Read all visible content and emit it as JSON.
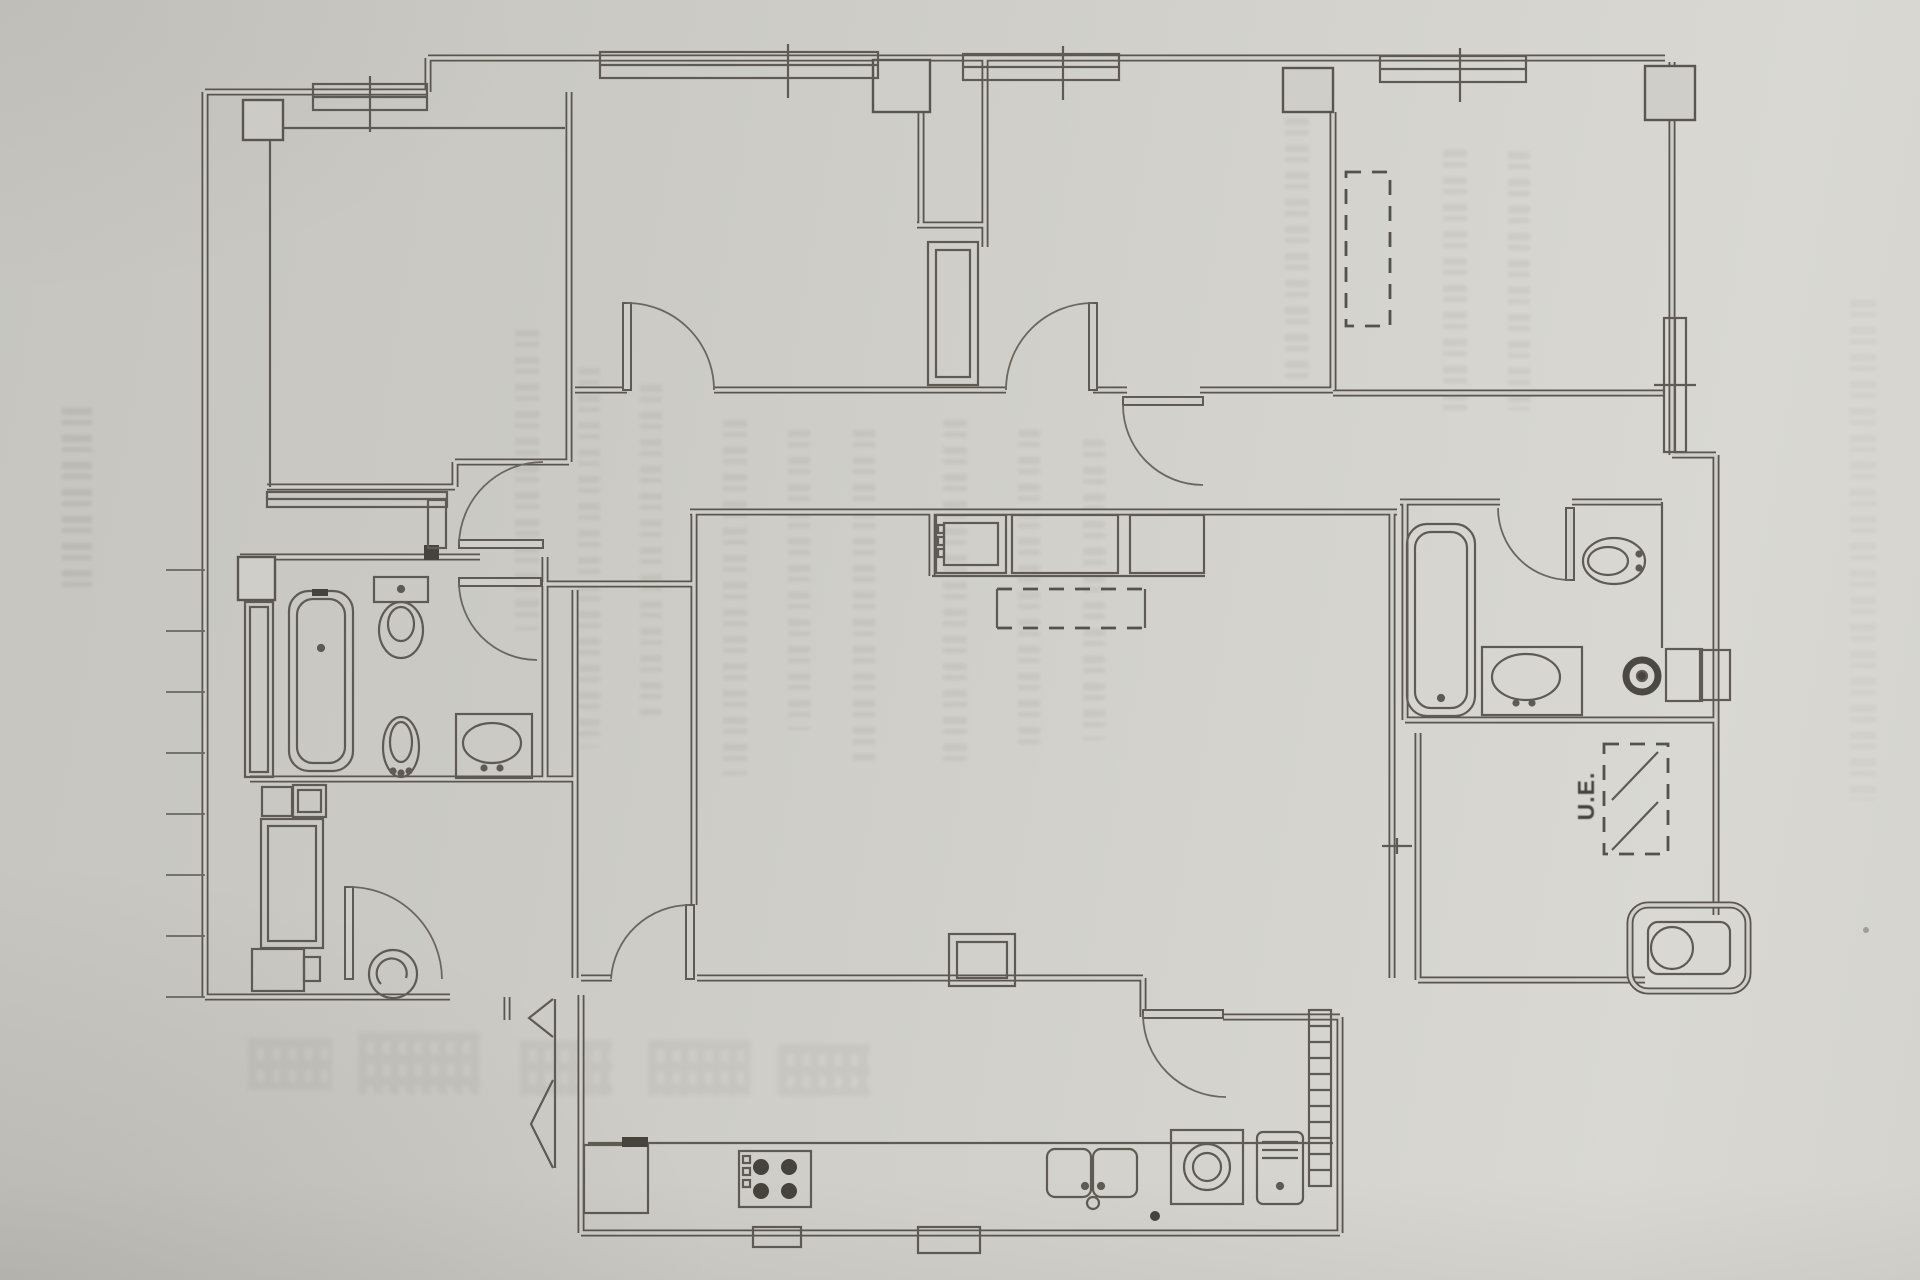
{
  "palette": {
    "paper": "#cdccc6",
    "paper_light": "#d9d8d2",
    "paper_dark": "#b9b8b2",
    "ink": "#5a564f",
    "ink_dark": "#46433c"
  },
  "plan": {
    "labels": {
      "exterior_unit": "U.E."
    },
    "rooms": [
      "bedroom-top-left",
      "bedroom-center-left",
      "bedroom-center-right",
      "bedroom-top-right",
      "bathroom-left",
      "bathroom-right",
      "hallway",
      "living-dining-room",
      "kitchen",
      "utility-gallery",
      "terrace-room"
    ],
    "fixtures": [
      "bathtub-left",
      "toilet-left",
      "bidet-left",
      "washbasin-left",
      "bathtub-right",
      "bidet-right",
      "washbasin-right",
      "toilet-right",
      "kitchen-sink-double",
      "cooktop-4-burners",
      "washing-machine",
      "water-heater",
      "storage-cupboard",
      "gallery-boiler",
      "wardrobe-dashed",
      "ac-outdoor-unit-dashed",
      "ladder-rack",
      "corridor-closets",
      "table-dashed",
      "corner-planter"
    ]
  }
}
